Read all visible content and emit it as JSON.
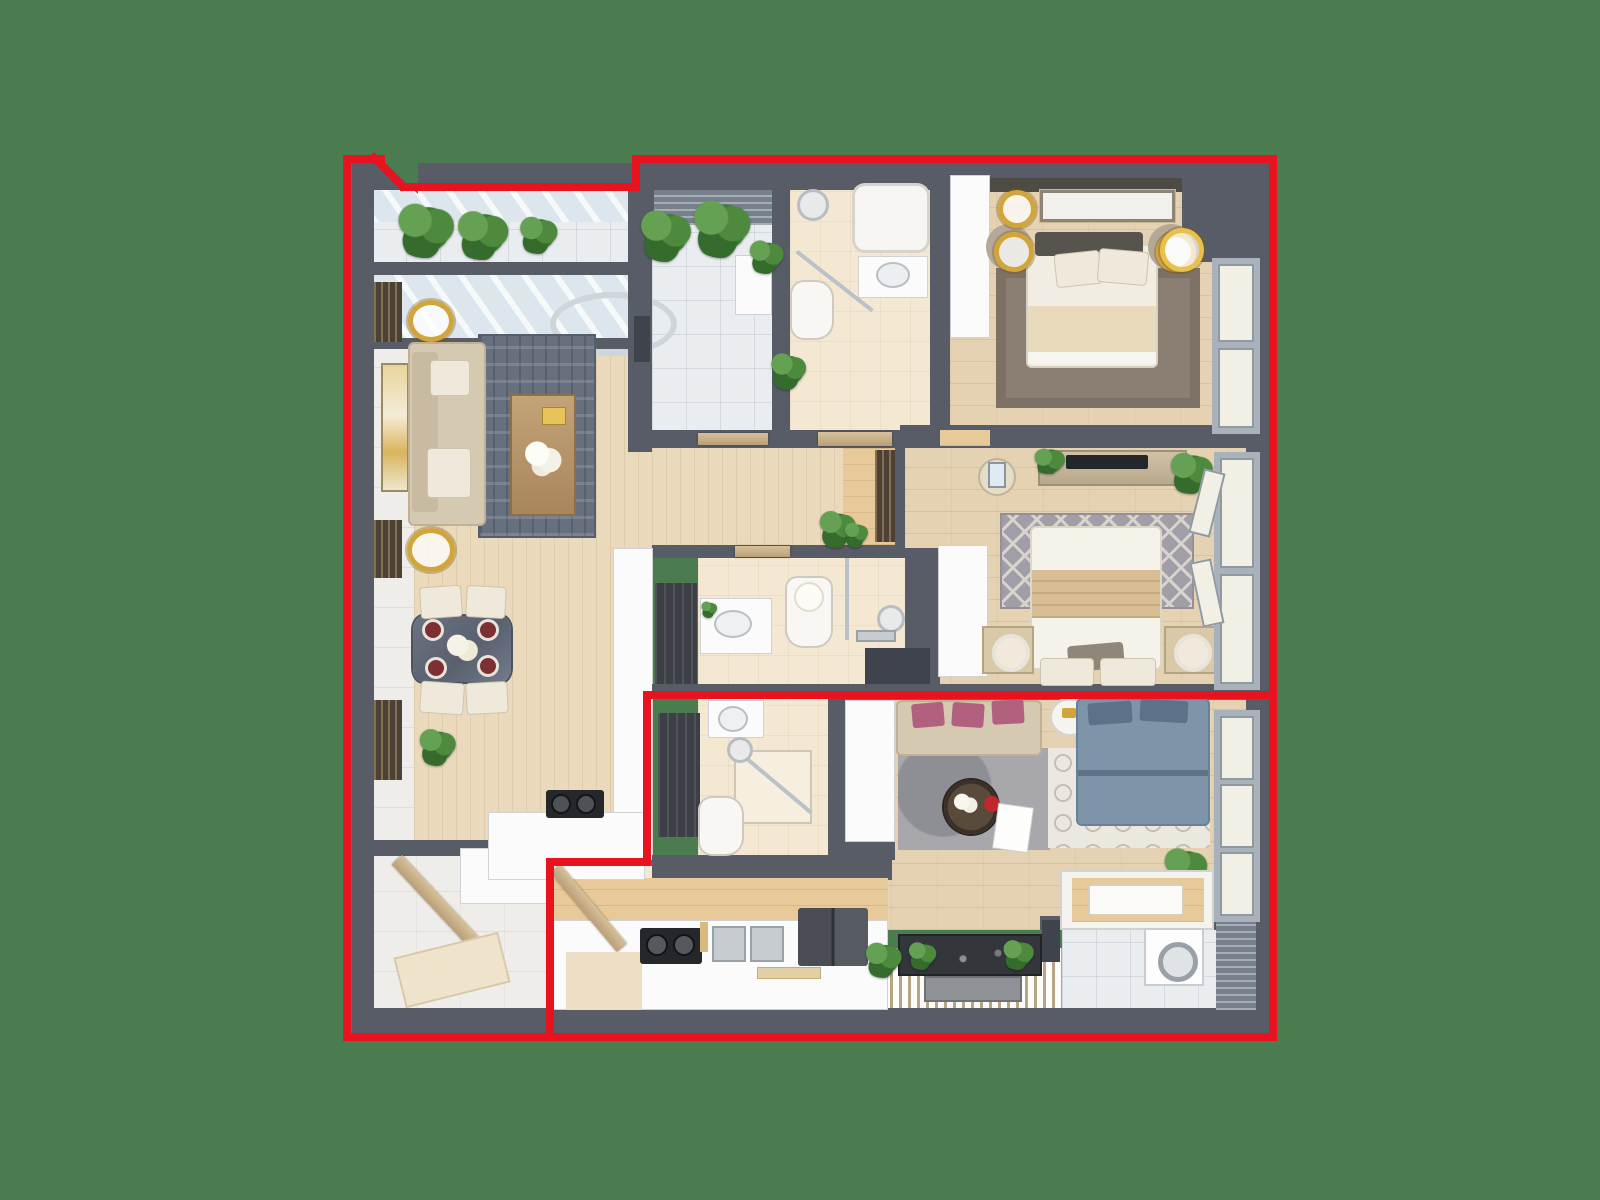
{
  "image_type": "apartment-floorplan-3d-top-view",
  "colors": {
    "bg": "#4a7c50",
    "red": "#e8131f",
    "wall": "#575c66",
    "walldark": "#3f434b",
    "gold": "#d2a53b"
  },
  "outline": {
    "color": "#e8131f",
    "stroke_px": 8,
    "description": "red unit boundary with notched top-left diagonal corner, inner cut separating lower-right studio section",
    "segments": [
      {
        "name": "left-edge",
        "x": 343,
        "y": 155,
        "w": 8,
        "h": 886
      },
      {
        "name": "top-left-stub",
        "x": 343,
        "y": 155,
        "w": 42,
        "h": 8
      },
      {
        "name": "top-diagonal",
        "x": 374,
        "y": 152,
        "w": 48,
        "h": 8,
        "rotate_deg": 45
      },
      {
        "name": "top-lower-run",
        "x": 400,
        "y": 183,
        "w": 240,
        "h": 8
      },
      {
        "name": "top-step",
        "x": 632,
        "y": 155,
        "w": 8,
        "h": 36
      },
      {
        "name": "top-main-run",
        "x": 632,
        "y": 155,
        "w": 645,
        "h": 8
      },
      {
        "name": "right-edge",
        "x": 1269,
        "y": 155,
        "w": 8,
        "h": 886
      },
      {
        "name": "bottom-edge",
        "x": 343,
        "y": 1033,
        "w": 934,
        "h": 8
      },
      {
        "name": "mid-horizontal",
        "x": 643,
        "y": 691,
        "w": 634,
        "h": 8
      },
      {
        "name": "mid-vertical-upper",
        "x": 643,
        "y": 691,
        "w": 8,
        "h": 175
      },
      {
        "name": "mid-jog-horizontal",
        "x": 546,
        "y": 858,
        "w": 105,
        "h": 8
      },
      {
        "name": "mid-vertical-lower",
        "x": 546,
        "y": 858,
        "w": 8,
        "h": 183
      }
    ]
  },
  "rooms": [
    {
      "name": "living-balcony",
      "features": [
        "glass-canopy",
        "potted-plants",
        "tile-floor",
        "glass-sliding-wall"
      ]
    },
    {
      "name": "living-room",
      "features": [
        "beige-sofa",
        "white-throw-pillows",
        "wood-coffee-table",
        "white-flowers",
        "dark-patterned-rug",
        "gold-wall-art",
        "slatted-media-panels",
        "ring-side-tables",
        "marble-gallery-strip",
        "ceiling-pendant-ring"
      ]
    },
    {
      "name": "dining-area",
      "features": [
        "slate-dining-table",
        "four-cream-chairs",
        "red-rimmed-plates",
        "white-centerpiece-flowers",
        "console-lamp",
        "plant"
      ]
    },
    {
      "name": "entry",
      "features": [
        "open-wood-door",
        "marble-floor",
        "angled-step-platform",
        "white-cabinet"
      ]
    },
    {
      "name": "kitchen",
      "features": [
        "white-counter",
        "black-cooktop",
        "double-stainless-sink",
        "gray-refrigerator",
        "peninsula-counter-with-hob",
        "steps",
        "open-wood-door",
        "plank-backsplash"
      ]
    },
    {
      "name": "utility-balcony",
      "features": [
        "louvered-canopy",
        "white-planter",
        "potted-plants",
        "tile-floor",
        "wall-shelf"
      ]
    },
    {
      "name": "bathroom-1",
      "features": [
        "shower-head",
        "bathtub",
        "vanity-sink",
        "toilet",
        "glass-partition",
        "door-threshold"
      ]
    },
    {
      "name": "bedroom-1",
      "features": [
        "double-bed-dark-headboard",
        "marble-overhead-panel",
        "gold-ring-lamps",
        "round-nightstands",
        "taupe-rug",
        "white-wardrobe",
        "corner-ac-block",
        "gold-chandelier",
        "window"
      ]
    },
    {
      "name": "hallway",
      "features": [
        "plant",
        "wood-floor",
        "closet-nook",
        "door-thresholds"
      ]
    },
    {
      "name": "bedroom-2",
      "features": [
        "double-bed-tan-blanket",
        "diamond-lattice-rug",
        "tv-console",
        "round-side-table",
        "sphere-lamps",
        "nightstands",
        "plants",
        "open-casement-windows",
        "white-closet"
      ]
    },
    {
      "name": "master-bathroom",
      "features": [
        "vanity-sink",
        "toilet",
        "glass-shower",
        "ceiling-light",
        "service-shaft"
      ]
    },
    {
      "name": "bathroom-2",
      "features": [
        "vanity-sink",
        "glass-shower",
        "toilet",
        "service-shaft"
      ]
    },
    {
      "name": "studio-living-room",
      "features": [
        "beige-sofa",
        "pink-cushions",
        "round-dark-coffee-table",
        "red-teapot",
        "gray-rug",
        "blue-daybed",
        "navy-pillows",
        "circle-pattern-rug",
        "gray-drawer-console",
        "round-tray-table",
        "plant",
        "grid-window"
      ]
    },
    {
      "name": "studio-dining",
      "features": [
        "wood-dining-table",
        "white-frame-legs",
        "washing-machine",
        "tile-floor",
        "paneled-wall"
      ]
    },
    {
      "name": "grill-balcony",
      "features": [
        "dark-planter-box",
        "pebbles",
        "plants",
        "slatted-floor",
        "inset-tray"
      ]
    }
  ]
}
